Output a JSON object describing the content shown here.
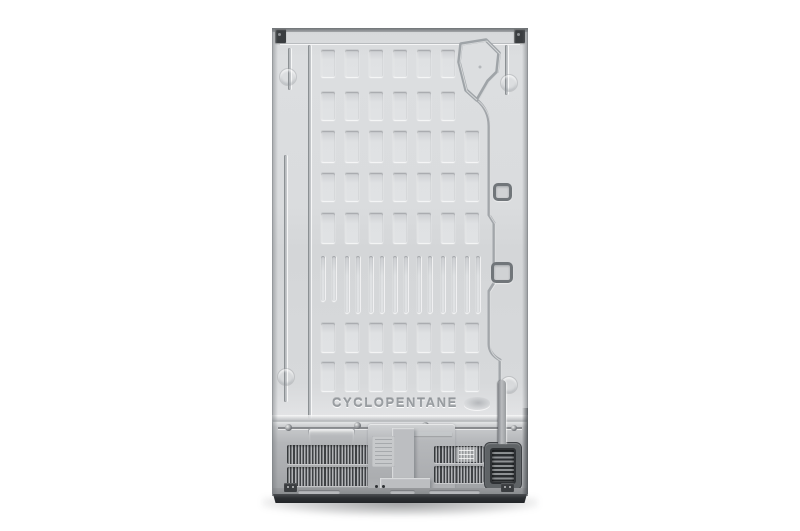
{
  "scene": {
    "description": "Product photo: rear view of refrigerator back panel on white background",
    "embossed_text": "CYCLOPENTANE",
    "background_color": "#ffffff"
  },
  "colors": {
    "panel": "#d8dadc",
    "panel_groove": "#a7abae",
    "compressor_bay": "#aeb0b3",
    "vent_slat_dark": "#3e4144",
    "condenser_grille": "#2a2d30",
    "base_strip": "#2c2f32",
    "hinge_bracket": "#3a3d40"
  }
}
